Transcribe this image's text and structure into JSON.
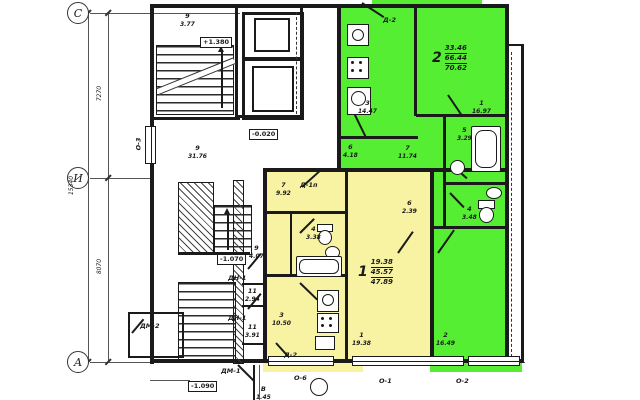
{
  "axes": {
    "top": "С",
    "middle": "И",
    "bottom": "А"
  },
  "dimensions": {
    "total": "15340",
    "upper_span": "7270",
    "lower_span": "8070"
  },
  "elevations": {
    "stair_landing": "+1.380",
    "lobby": "-0.020",
    "mid_stair": "-1.070",
    "entrance": "-1.090"
  },
  "apartments": {
    "apt2": {
      "number": "2",
      "living": "33.46",
      "usable": "66.44",
      "total": "70.62",
      "fill": "#55ee33"
    },
    "apt1": {
      "number": "1",
      "living": "19.38",
      "usable": "45.57",
      "total": "47.89",
      "fill": "#f7f3a2"
    }
  },
  "rooms": [
    {
      "num": "9",
      "area": "3.77"
    },
    {
      "num": "9",
      "area": "31.76"
    },
    {
      "num": "9",
      "area": "4.07"
    },
    {
      "num": "11",
      "area": "2.94"
    },
    {
      "num": "11",
      "area": "3.91"
    },
    {
      "num": "3",
      "area": "14.47"
    },
    {
      "num": "1",
      "area": "16.97"
    },
    {
      "num": "5",
      "area": "3.29"
    },
    {
      "num": "4",
      "area": "3.48"
    },
    {
      "num": "7",
      "area": "11.74"
    },
    {
      "num": "6",
      "area": "4.18"
    },
    {
      "num": "7",
      "area": "9.92"
    },
    {
      "num": "4",
      "area": "3.38"
    },
    {
      "num": "6",
      "area": "2.39"
    },
    {
      "num": "3",
      "area": "10.50"
    },
    {
      "num": "1",
      "area": "19.38"
    },
    {
      "num": "2",
      "area": "16.49"
    },
    {
      "num": "В",
      "area": "1.45"
    }
  ],
  "door_marks": {
    "d2_top": "Д-2",
    "d1p": "Д-1п",
    "d2_balcony": "Д-2",
    "dn1_a": "ДН-1",
    "dn1_b": "ДН-1",
    "dm1": "ДМ-1",
    "dm2": "ДМ-2"
  },
  "window_marks": {
    "o3": "О-3",
    "o6": "О-6",
    "o1": "О-1",
    "o2": "О-2"
  }
}
